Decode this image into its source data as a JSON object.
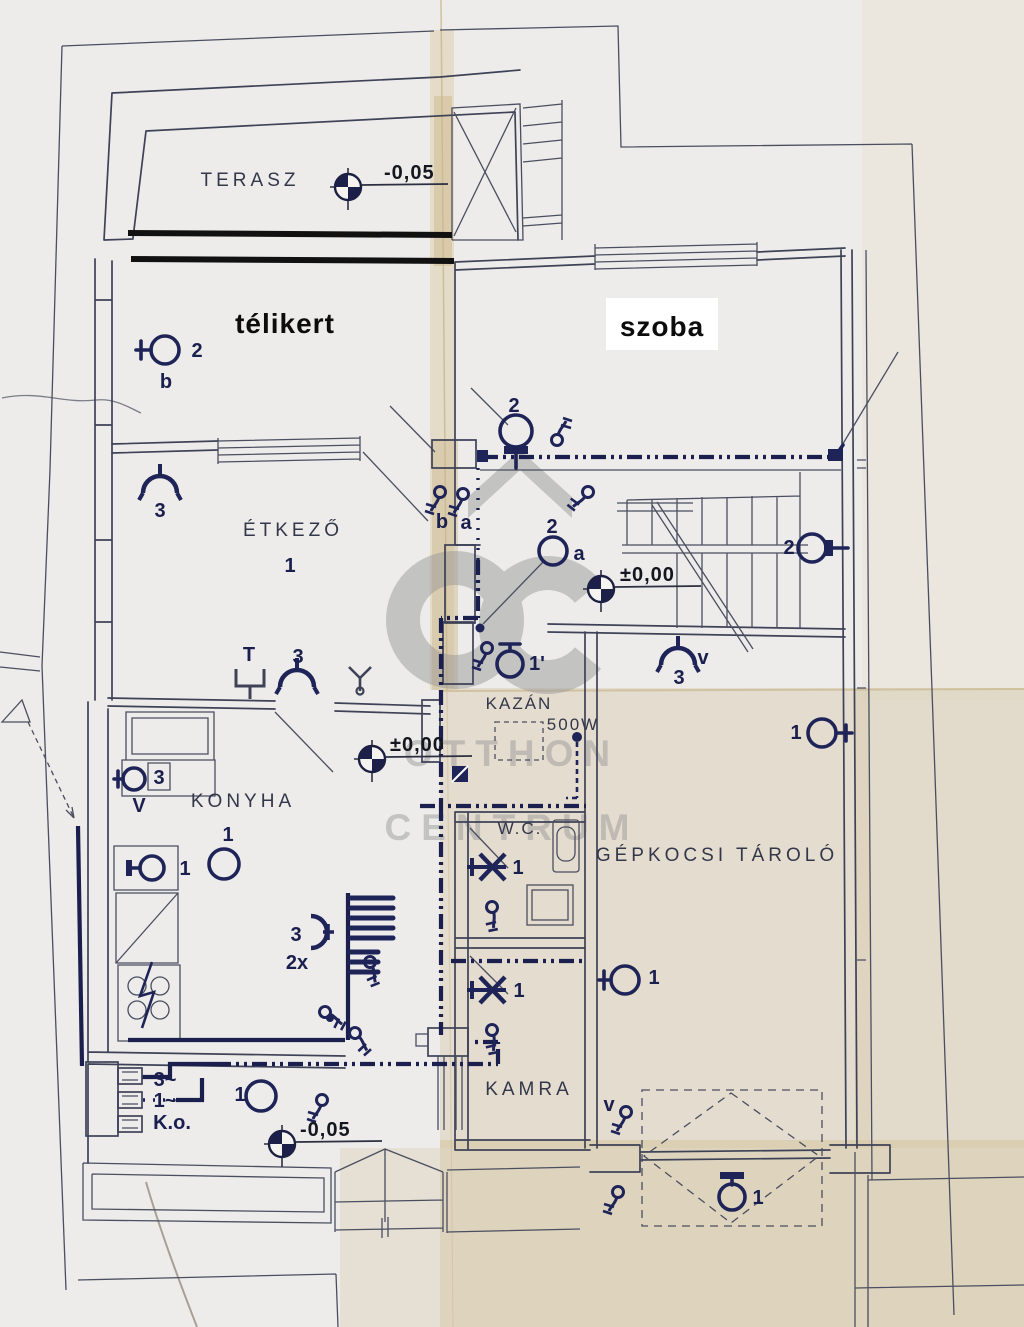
{
  "document": {
    "kind": "scanned electrical floor plan",
    "language": "hu"
  },
  "watermark": {
    "brand": "Otthon Centrum",
    "logo": "oc-house-logo",
    "line1": "OTTHON",
    "line2": "CENTRUM",
    "color": "#9b9b9b"
  },
  "rooms": [
    {
      "name": "terasz",
      "label": "TERASZ",
      "x": 250,
      "y": 186,
      "cls": "room"
    },
    {
      "name": "telikert",
      "label": "télikert",
      "x": 285,
      "y": 333,
      "cls": "room-bold"
    },
    {
      "name": "szoba",
      "label": "szoba",
      "x": 662,
      "y": 336,
      "cls": "room-bold"
    },
    {
      "name": "etkezo",
      "label": "ÉTKEZŐ",
      "x": 293,
      "y": 536,
      "cls": "room"
    },
    {
      "name": "konyha",
      "label": "KONYHA",
      "x": 243,
      "y": 807,
      "cls": "room"
    },
    {
      "name": "kazan",
      "label": "KAZÁN",
      "x": 519,
      "y": 709,
      "cls": "room-sm"
    },
    {
      "name": "kazan-power",
      "label": "500W",
      "x": 573,
      "y": 730,
      "cls": "room-sm"
    },
    {
      "name": "wc",
      "label": "W.C.",
      "x": 520,
      "y": 834,
      "cls": "room-sm"
    },
    {
      "name": "garage",
      "label": "GÉPKOCSI TÁROLÓ",
      "x": 717,
      "y": 861,
      "cls": "room"
    },
    {
      "name": "kamra",
      "label": "KAMRA",
      "x": 529,
      "y": 1095,
      "cls": "room"
    }
  ],
  "elevations": [
    {
      "name": "terasz-level",
      "text": "-0,05",
      "mx": 348,
      "my": 187,
      "tx": 384,
      "ty": 179
    },
    {
      "name": "hall-level",
      "text": "±0,00",
      "mx": 601,
      "my": 589,
      "tx": 620,
      "ty": 581
    },
    {
      "name": "konyha-level",
      "text": "±0,00",
      "mx": 372,
      "my": 759,
      "tx": 390,
      "ty": 751
    },
    {
      "name": "garden-level",
      "text": "-0,05",
      "mx": 282,
      "my": 1144,
      "tx": 300,
      "ty": 1136
    }
  ],
  "annotations": [
    {
      "name": "telikert-lamp-count",
      "text": "2",
      "x": 197,
      "y": 357
    },
    {
      "name": "telikert-circuit-b",
      "text": "b",
      "x": 166,
      "y": 388
    },
    {
      "name": "etkezo-rose-count",
      "text": "3",
      "x": 160,
      "y": 517
    },
    {
      "name": "etkezo-point-count",
      "text": "1",
      "x": 290,
      "y": 572
    },
    {
      "name": "hall-switch-b",
      "text": "b",
      "x": 442,
      "y": 528
    },
    {
      "name": "hall-switch-a",
      "text": "a",
      "x": 466,
      "y": 529
    },
    {
      "name": "szoba-lamp-count",
      "text": "2",
      "x": 514,
      "y": 412
    },
    {
      "name": "hall-lamp-count",
      "text": "2",
      "x": 552,
      "y": 533
    },
    {
      "name": "hall-lamp-circuit",
      "text": "a",
      "x": 579,
      "y": 560
    },
    {
      "name": "stair-lamp-count",
      "text": "2",
      "x": 789,
      "y": 554
    },
    {
      "name": "kazan-lamp-count",
      "text": "1'",
      "x": 537,
      "y": 670
    },
    {
      "name": "garage-rose-circuit",
      "text": "v",
      "x": 703,
      "y": 664
    },
    {
      "name": "garage-rose-count",
      "text": "3",
      "x": 679,
      "y": 684
    },
    {
      "name": "garage-lamp-top-count",
      "text": "1",
      "x": 796,
      "y": 739
    },
    {
      "name": "garage-lamp-bottom-count",
      "text": "1",
      "x": 654,
      "y": 984
    },
    {
      "name": "wc-lamp-count",
      "text": "1",
      "x": 518,
      "y": 874
    },
    {
      "name": "kamra-lamp-count",
      "text": "1",
      "x": 519,
      "y": 997
    },
    {
      "name": "konyha-outlet-t",
      "text": "T",
      "x": 249,
      "y": 661
    },
    {
      "name": "konyha-rose-count",
      "text": "3",
      "x": 298,
      "y": 663
    },
    {
      "name": "konyha-point-count",
      "text": "1",
      "x": 228,
      "y": 841
    },
    {
      "name": "unit-lamp-count",
      "text": "3",
      "x": 159,
      "y": 784
    },
    {
      "name": "unit-vent",
      "text": "V",
      "x": 139,
      "y": 812
    },
    {
      "name": "konyha-wall-lamp-count",
      "text": "1",
      "x": 185,
      "y": 875
    },
    {
      "name": "konyha-rose2-count",
      "text": "3",
      "x": 296,
      "y": 941
    },
    {
      "name": "konyha-rose2-mult",
      "text": "2x",
      "x": 297,
      "y": 969
    },
    {
      "name": "feed-three-phase",
      "text": "3~",
      "x": 165,
      "y": 1086
    },
    {
      "name": "feed-single-phase",
      "text": "1~",
      "x": 165,
      "y": 1107
    },
    {
      "name": "feed-ko",
      "text": "K.o.",
      "x": 172,
      "y": 1129
    },
    {
      "name": "entry-lamp-count",
      "text": "1",
      "x": 240,
      "y": 1101
    },
    {
      "name": "kamra-vent",
      "text": "v",
      "x": 609,
      "y": 1111
    },
    {
      "name": "canopy-lamp-count",
      "text": "1",
      "x": 758,
      "y": 1204
    }
  ],
  "symbols": {
    "pendant_lamp": "circle-lamp-icon",
    "wall_lamp": "circle-lamp-with-bracket-icon",
    "ceiling_rose": "arc-lamp-icon",
    "wall_light": "x-lamp-icon",
    "switch": "switch-icon",
    "elevation_marker": "survey-level-icon",
    "distribution_board": "meter-box-icon",
    "boiler": "dashed-box-icon",
    "canopy": "dashed-diamond-icon"
  },
  "colors": {
    "paper": "#edecea",
    "stain": "#d9c8a2",
    "ink": "#3e4257",
    "electric": "#1f2458",
    "heavy_line": "#111111",
    "watermark": "#9b9b9b"
  }
}
